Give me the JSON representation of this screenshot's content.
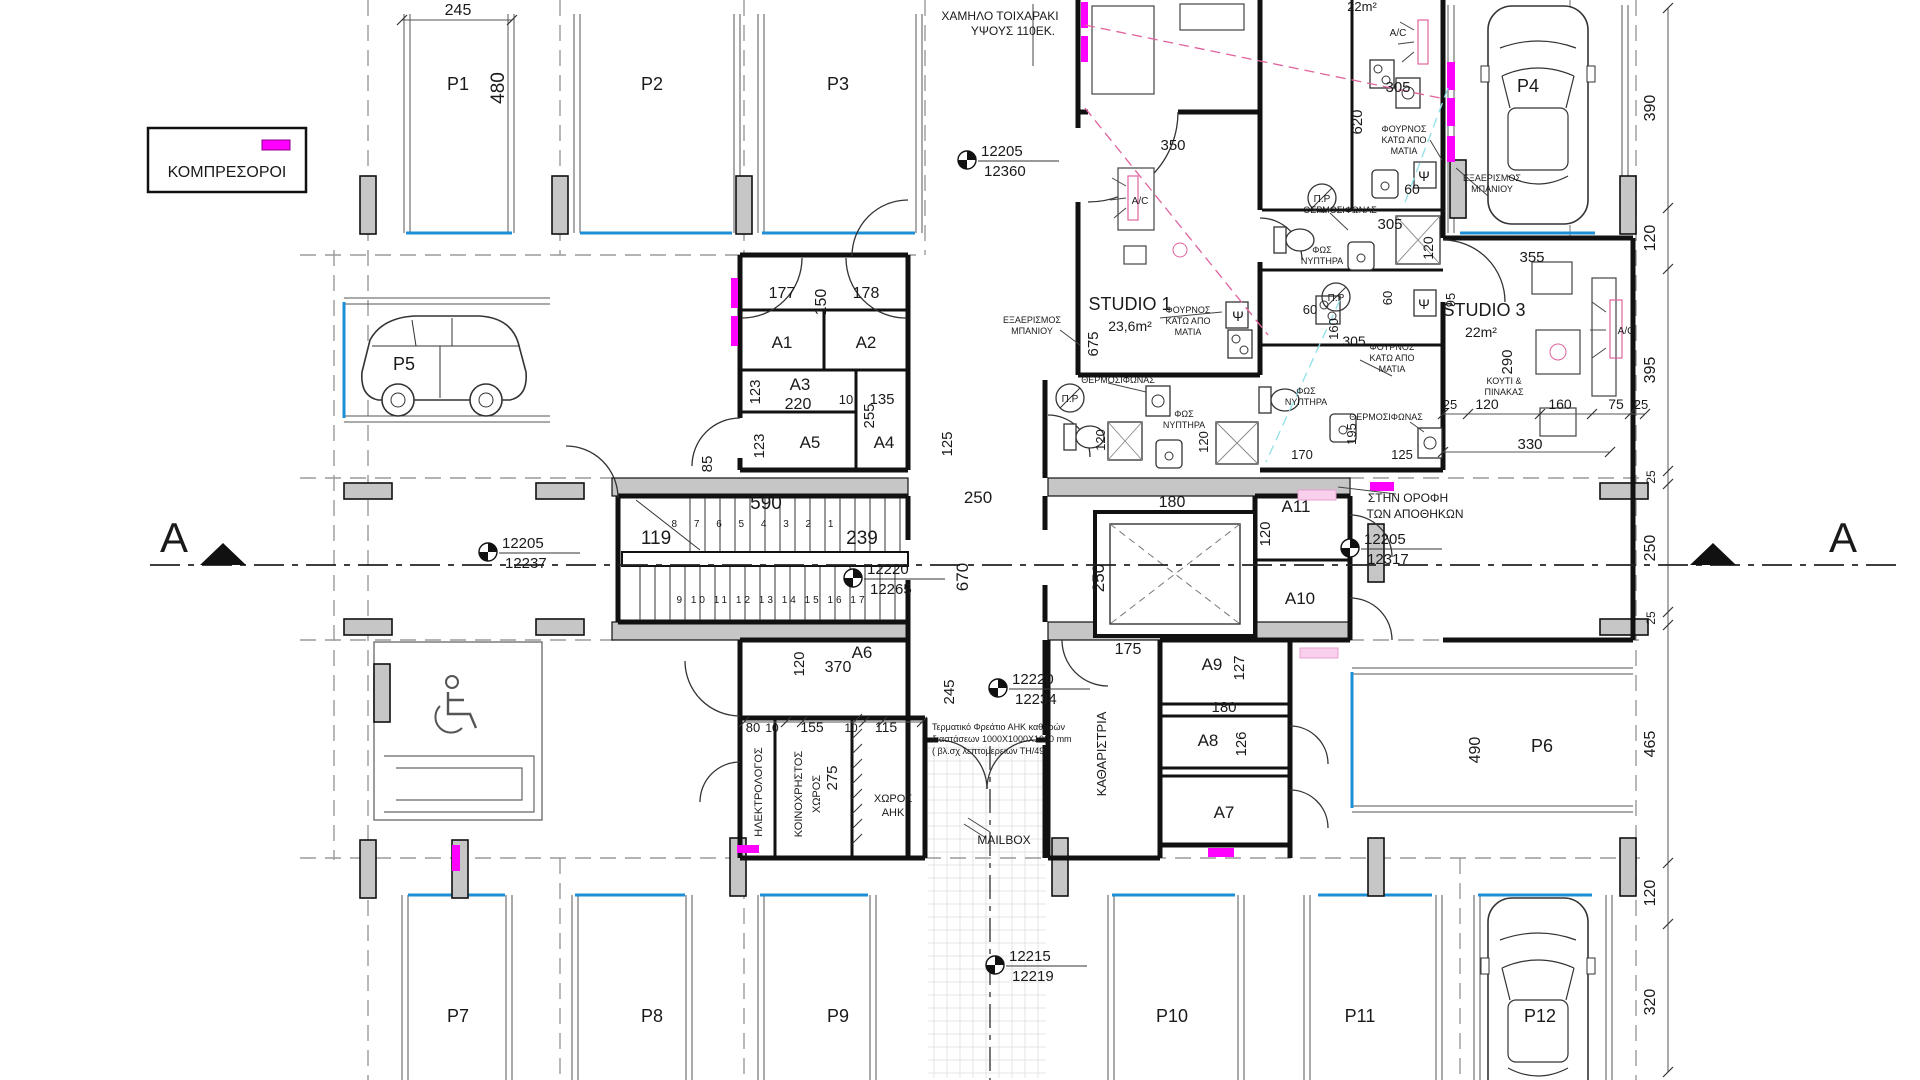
{
  "legend": {
    "label": "ΚΟΜΠΡΕΣΟΡΟΙ"
  },
  "section": {
    "left": "A",
    "right": "A"
  },
  "colors": {
    "magenta": "#FF00FF",
    "stall_blue": "#1C8FD6",
    "wall_black": "#111111",
    "column_gray": "#C6C6C6",
    "grid_gray": "#9A9A9A",
    "pink_dashed": "#E0639E",
    "pale_pink": "#F8D0EC",
    "cyan": "#8FE0E8",
    "text": "#1a1a1a"
  },
  "parking": [
    {
      "id": "P1",
      "x": 458,
      "y": 90
    },
    {
      "id": "P2",
      "x": 652,
      "y": 90
    },
    {
      "id": "P3",
      "x": 838,
      "y": 90
    },
    {
      "id": "P4",
      "x": 1528,
      "y": 92
    },
    {
      "id": "P5",
      "x": 404,
      "y": 370
    },
    {
      "id": "P6",
      "x": 1542,
      "y": 752
    },
    {
      "id": "P7",
      "x": 458,
      "y": 1022
    },
    {
      "id": "P8",
      "x": 652,
      "y": 1022
    },
    {
      "id": "P9",
      "x": 838,
      "y": 1022
    },
    {
      "id": "P10",
      "x": 1172,
      "y": 1022
    },
    {
      "id": "P11",
      "x": 1360,
      "y": 1022
    },
    {
      "id": "P12",
      "x": 1540,
      "y": 1022
    }
  ],
  "rooms": [
    {
      "id": "A1",
      "x": 782,
      "y": 348
    },
    {
      "id": "A2",
      "x": 866,
      "y": 348
    },
    {
      "id": "A3",
      "x": 800,
      "y": 390
    },
    {
      "id": "A4",
      "x": 884,
      "y": 448
    },
    {
      "id": "A5",
      "x": 810,
      "y": 448
    },
    {
      "id": "A6",
      "x": 862,
      "y": 658
    },
    {
      "id": "A7",
      "x": 1224,
      "y": 818
    },
    {
      "id": "A8",
      "x": 1208,
      "y": 746
    },
    {
      "id": "A9",
      "x": 1212,
      "y": 670
    },
    {
      "id": "A10",
      "x": 1300,
      "y": 604
    },
    {
      "id": "A11",
      "x": 1296,
      "y": 512
    }
  ],
  "survey_markers": [
    {
      "upper": "12205",
      "lower": "12360",
      "x": 967,
      "y": 160
    },
    {
      "upper": "12205",
      "lower": "12237",
      "x": 488,
      "y": 552
    },
    {
      "upper": "12220",
      "lower": "12265",
      "x": 853,
      "y": 578
    },
    {
      "upper": "12205",
      "lower": "12317",
      "x": 1350,
      "y": 548
    },
    {
      "upper": "12220",
      "lower": "12234",
      "x": 998,
      "y": 688
    },
    {
      "upper": "12215",
      "lower": "12219",
      "x": 995,
      "y": 965
    }
  ],
  "dimensions": [
    {
      "t": "245",
      "x": 458,
      "y": 15,
      "s": 16
    },
    {
      "t": "480",
      "x": 504,
      "y": 88,
      "r": 1,
      "s": 19
    },
    {
      "t": "390",
      "x": 1655,
      "y": 108,
      "r": 1,
      "s": 16
    },
    {
      "t": "120",
      "x": 1655,
      "y": 238,
      "r": 1,
      "s": 16
    },
    {
      "t": "395",
      "x": 1655,
      "y": 370,
      "r": 1,
      "s": 16
    },
    {
      "t": "25",
      "x": 1655,
      "y": 477,
      "r": 1,
      "s": 12
    },
    {
      "t": "250",
      "x": 1655,
      "y": 548,
      "r": 1,
      "s": 16
    },
    {
      "t": "25",
      "x": 1655,
      "y": 618,
      "r": 1,
      "s": 12
    },
    {
      "t": "465",
      "x": 1655,
      "y": 744,
      "r": 1,
      "s": 16
    },
    {
      "t": "120",
      "x": 1655,
      "y": 893,
      "r": 1,
      "s": 16
    },
    {
      "t": "320",
      "x": 1655,
      "y": 1002,
      "r": 1,
      "s": 16
    },
    {
      "t": "350",
      "x": 1173,
      "y": 150,
      "s": 15
    },
    {
      "t": "305",
      "x": 1398,
      "y": 92,
      "s": 15
    },
    {
      "t": "620",
      "x": 1362,
      "y": 122,
      "r": 1,
      "s": 15
    },
    {
      "t": "60",
      "x": 1412,
      "y": 194,
      "s": 14
    },
    {
      "t": "305",
      "x": 1390,
      "y": 229,
      "s": 15
    },
    {
      "t": "120",
      "x": 1433,
      "y": 248,
      "r": 1,
      "s": 14
    },
    {
      "t": "355",
      "x": 1532,
      "y": 262,
      "s": 15
    },
    {
      "t": "95",
      "x": 1455,
      "y": 300,
      "r": 1,
      "s": 13
    },
    {
      "t": "290",
      "x": 1512,
      "y": 362,
      "r": 1,
      "s": 15
    },
    {
      "t": "60",
      "x": 1310,
      "y": 314,
      "s": 13
    },
    {
      "t": "60",
      "x": 1392,
      "y": 298,
      "r": 1,
      "s": 13
    },
    {
      "t": "160",
      "x": 1338,
      "y": 329,
      "r": 1,
      "s": 13
    },
    {
      "t": "305",
      "x": 1354,
      "y": 346,
      "s": 14
    },
    {
      "t": "195",
      "x": 1356,
      "y": 434,
      "r": 1,
      "s": 13
    },
    {
      "t": "170",
      "x": 1302,
      "y": 459,
      "s": 13
    },
    {
      "t": "125",
      "x": 1402,
      "y": 459,
      "s": 13
    },
    {
      "t": "25",
      "x": 1450,
      "y": 409,
      "s": 13
    },
    {
      "t": "120",
      "x": 1487,
      "y": 409,
      "s": 14
    },
    {
      "t": "160",
      "x": 1560,
      "y": 409,
      "s": 14
    },
    {
      "t": "75",
      "x": 1616,
      "y": 409,
      "s": 14
    },
    {
      "t": "25",
      "x": 1641,
      "y": 409,
      "s": 13
    },
    {
      "t": "330",
      "x": 1530,
      "y": 449,
      "s": 15
    },
    {
      "t": "177",
      "x": 782,
      "y": 298,
      "s": 16
    },
    {
      "t": "150",
      "x": 826,
      "y": 302,
      "r": 1,
      "s": 16
    },
    {
      "t": "178",
      "x": 866,
      "y": 298,
      "s": 16
    },
    {
      "t": "123",
      "x": 760,
      "y": 392,
      "r": 1,
      "s": 15
    },
    {
      "t": "220",
      "x": 798,
      "y": 409,
      "s": 16
    },
    {
      "t": "10",
      "x": 846,
      "y": 404,
      "s": 13
    },
    {
      "t": "135",
      "x": 882,
      "y": 404,
      "s": 15
    },
    {
      "t": "255",
      "x": 874,
      "y": 416,
      "r": 1,
      "s": 15
    },
    {
      "t": "123",
      "x": 764,
      "y": 446,
      "r": 1,
      "s": 15
    },
    {
      "t": "125",
      "x": 952,
      "y": 444,
      "r": 1,
      "s": 15
    },
    {
      "t": "85",
      "x": 712,
      "y": 464,
      "r": 1,
      "s": 15
    },
    {
      "t": "590",
      "x": 766,
      "y": 509,
      "s": 19
    },
    {
      "t": "119",
      "x": 656,
      "y": 544,
      "s": 19
    },
    {
      "t": "239",
      "x": 862,
      "y": 544,
      "s": 19
    },
    {
      "t": "250",
      "x": 978,
      "y": 503,
      "s": 17
    },
    {
      "t": "670",
      "x": 968,
      "y": 577,
      "r": 1,
      "s": 17
    },
    {
      "t": "180",
      "x": 1172,
      "y": 507,
      "s": 16
    },
    {
      "t": "250",
      "x": 1104,
      "y": 578,
      "r": 1,
      "s": 17
    },
    {
      "t": "120",
      "x": 1270,
      "y": 534,
      "r": 1,
      "s": 15
    },
    {
      "t": "675",
      "x": 1098,
      "y": 344,
      "r": 1,
      "s": 15
    },
    {
      "t": "120",
      "x": 1105,
      "y": 440,
      "r": 1,
      "s": 13
    },
    {
      "t": "120",
      "x": 1208,
      "y": 442,
      "r": 1,
      "s": 13
    },
    {
      "t": "175",
      "x": 1128,
      "y": 654,
      "s": 16
    },
    {
      "t": "127",
      "x": 1244,
      "y": 668,
      "r": 1,
      "s": 15
    },
    {
      "t": "180",
      "x": 1224,
      "y": 712,
      "s": 15
    },
    {
      "t": "126",
      "x": 1246,
      "y": 744,
      "r": 1,
      "s": 15
    },
    {
      "t": "120",
      "x": 804,
      "y": 664,
      "r": 1,
      "s": 15
    },
    {
      "t": "370",
      "x": 838,
      "y": 672,
      "s": 16
    },
    {
      "t": "245",
      "x": 954,
      "y": 692,
      "r": 1,
      "s": 15
    },
    {
      "t": "80",
      "x": 753,
      "y": 732,
      "s": 13
    },
    {
      "t": "10",
      "x": 772,
      "y": 732,
      "s": 12
    },
    {
      "t": "155",
      "x": 812,
      "y": 732,
      "s": 14
    },
    {
      "t": "10",
      "x": 851,
      "y": 732,
      "s": 12
    },
    {
      "t": "115",
      "x": 886,
      "y": 732,
      "s": 14
    },
    {
      "t": "275",
      "x": 837,
      "y": 778,
      "r": 1,
      "s": 15
    },
    {
      "t": "490",
      "x": 1480,
      "y": 750,
      "r": 1,
      "s": 16
    }
  ],
  "annotations": [
    {
      "t": "ΧΑΜΗΛΟ ΤΟΙΧΑΡΑΚΙ",
      "x": 1000,
      "y": 20,
      "s": 12,
      "n": "note-low-wall-line1"
    },
    {
      "t": "ΥΨΟΥΣ 110ΕΚ.",
      "x": 1013,
      "y": 35,
      "s": 12,
      "n": "note-low-wall-line2"
    },
    {
      "t": "STUDIO 1",
      "x": 1130,
      "y": 310,
      "s": 18,
      "n": "label-studio1"
    },
    {
      "t": "23,6m²",
      "x": 1130,
      "y": 331,
      "s": 14,
      "n": "label-studio1-area"
    },
    {
      "t": "STUDIO 3",
      "x": 1484,
      "y": 316,
      "s": 18,
      "n": "label-studio3"
    },
    {
      "t": "22m²",
      "x": 1481,
      "y": 337,
      "s": 14,
      "n": "label-studio3-area"
    },
    {
      "t": "22m²",
      "x": 1362,
      "y": 11,
      "s": 13,
      "n": "label-studio2-area"
    },
    {
      "t": "ΕΞΑΕΡΙΣΜΟΣ",
      "x": 1032,
      "y": 323,
      "s": 9,
      "n": "note-vent-bath-1a"
    },
    {
      "t": "ΜΠΑΝΙΟΥ",
      "x": 1032,
      "y": 334,
      "s": 9,
      "n": "note-vent-bath-1b"
    },
    {
      "t": "ΕΞΑΕΡΙΣΜΟΣ",
      "x": 1492,
      "y": 181,
      "s": 9,
      "n": "note-vent-bath-2a"
    },
    {
      "t": "ΜΠΑΝΙΟΥ",
      "x": 1492,
      "y": 192,
      "s": 9,
      "n": "note-vent-bath-2b"
    },
    {
      "t": "ΦΟΥΡΝΟΣ",
      "x": 1188,
      "y": 313,
      "s": 9
    },
    {
      "t": "ΚΑΤΩ ΑΠΟ",
      "x": 1188,
      "y": 324,
      "s": 9
    },
    {
      "t": "ΜΑΤΙΑ",
      "x": 1188,
      "y": 335,
      "s": 9
    },
    {
      "t": "ΦΟΥΡΝΟΣ",
      "x": 1404,
      "y": 132,
      "s": 9
    },
    {
      "t": "ΚΑΤΩ ΑΠΟ",
      "x": 1404,
      "y": 143,
      "s": 9
    },
    {
      "t": "ΜΑΤΙΑ",
      "x": 1404,
      "y": 154,
      "s": 9
    },
    {
      "t": "ΦΟΥΡΝΟΣ",
      "x": 1392,
      "y": 350,
      "s": 9
    },
    {
      "t": "ΚΑΤΩ ΑΠΟ",
      "x": 1392,
      "y": 361,
      "s": 9
    },
    {
      "t": "ΜΑΤΙΑ",
      "x": 1392,
      "y": 372,
      "s": 9
    },
    {
      "t": "ΘΕΡΜΟΣΙΦΩΝΑΣ",
      "x": 1340,
      "y": 213,
      "s": 9
    },
    {
      "t": "ΘΕΡΜΟΣΙΦΩΝΑΣ",
      "x": 1118,
      "y": 383,
      "s": 9
    },
    {
      "t": "ΘΕΡΜΟΣΙΦΩΝΑΣ",
      "x": 1386,
      "y": 420,
      "s": 9
    },
    {
      "t": "ΦΩΣ",
      "x": 1322,
      "y": 253,
      "s": 9
    },
    {
      "t": "ΝΥΠΤΗΡΑ",
      "x": 1322,
      "y": 264,
      "s": 9
    },
    {
      "t": "ΦΩΣ",
      "x": 1184,
      "y": 417,
      "s": 9
    },
    {
      "t": "ΝΥΠΤΗΡΑ",
      "x": 1184,
      "y": 428,
      "s": 9
    },
    {
      "t": "ΦΩΣ",
      "x": 1306,
      "y": 394,
      "s": 9
    },
    {
      "t": "ΝΥΠΤΗΡΑ",
      "x": 1306,
      "y": 405,
      "s": 9
    },
    {
      "t": "Π.Ρ",
      "x": 1322,
      "y": 202,
      "s": 10
    },
    {
      "t": "Π.Ρ",
      "x": 1070,
      "y": 402,
      "s": 10
    },
    {
      "t": "Π.Ρ",
      "x": 1336,
      "y": 301,
      "s": 10
    },
    {
      "t": "Ψ",
      "x": 1424,
      "y": 181,
      "s": 14
    },
    {
      "t": "Ψ",
      "x": 1424,
      "y": 309,
      "s": 14
    },
    {
      "t": "Ψ",
      "x": 1238,
      "y": 321,
      "s": 14
    },
    {
      "t": "A/C",
      "x": 1140,
      "y": 204,
      "s": 10
    },
    {
      "t": "A/C",
      "x": 1398,
      "y": 36,
      "s": 10
    },
    {
      "t": "A/C",
      "x": 1626,
      "y": 334,
      "s": 10
    },
    {
      "t": "ΚΟΥΤΙ &",
      "x": 1504,
      "y": 384,
      "s": 9
    },
    {
      "t": "ΠΙΝΑΚΑΣ",
      "x": 1504,
      "y": 395,
      "s": 9
    },
    {
      "t": "ΣΤΗΝ ΟΡΟΦΗ",
      "x": 1408,
      "y": 502,
      "s": 12
    },
    {
      "t": "ΤΩΝ ΑΠΟΘΗΚΩΝ",
      "x": 1415,
      "y": 518,
      "s": 12
    },
    {
      "t": "ΚΑΘΑΡΙΣΤΡΙΑ",
      "x": 1106,
      "y": 754,
      "r": 1,
      "s": 13
    },
    {
      "t": "ΗΛΕΚΤΡΟΛΟΓΟΣ",
      "x": 762,
      "y": 792,
      "r": 1,
      "s": 11
    },
    {
      "t": "ΚΟΙΝΟΧΡΗΣΤΟΣ",
      "x": 802,
      "y": 794,
      "r": 1,
      "s": 11
    },
    {
      "t": "ΧΩΡΟΣ",
      "x": 820,
      "y": 794,
      "r": 1,
      "s": 11
    },
    {
      "t": "ΧΩΡΟΣ",
      "x": 893,
      "y": 802,
      "s": 11
    },
    {
      "t": "ΑΗΚ",
      "x": 893,
      "y": 816,
      "s": 11
    },
    {
      "t": "MAILBOX",
      "x": 1004,
      "y": 844,
      "s": 12,
      "n": "label-mailbox"
    },
    {
      "t": "Τερματικό Φρεάτιο ΑΗΚ καθαρών",
      "x": 932,
      "y": 730,
      "s": 9,
      "a": "start",
      "n": "note-ahk-1"
    },
    {
      "t": "διαστάσεων 1000X1000X1000 mm",
      "x": 932,
      "y": 742,
      "s": 9,
      "a": "start",
      "n": "note-ahk-2"
    },
    {
      "t": "( βλ.σχ λεπτομερειών ΤΗ/49)",
      "x": 932,
      "y": 754,
      "s": 9,
      "a": "start",
      "n": "note-ahk-3"
    },
    {
      "t": "8 7 6 5 4 3 2 1",
      "x": 756,
      "y": 527,
      "s": 10,
      "ls": 7,
      "n": "stair-numbers-upper"
    },
    {
      "t": "9 10 11 12 13 14 15 16 17",
      "x": 772,
      "y": 603,
      "s": 10,
      "ls": 3,
      "n": "stair-numbers-lower"
    }
  ]
}
